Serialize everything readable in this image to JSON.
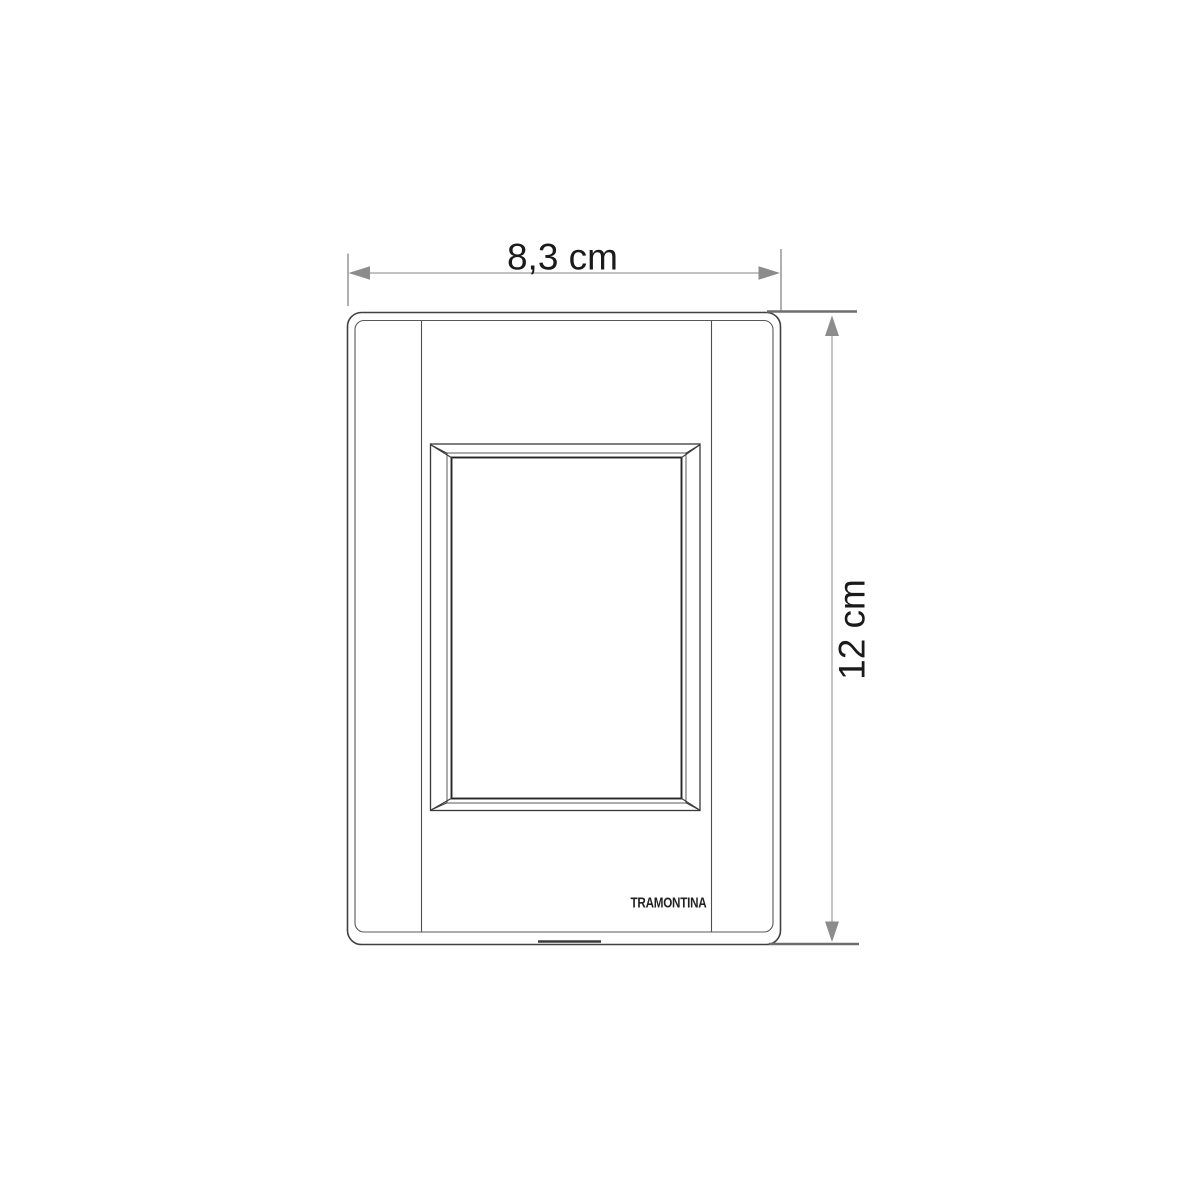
{
  "diagram": {
    "labels": {
      "width": "8,3 cm",
      "height": "12 cm",
      "brand": "TRAMONTINA"
    },
    "colors": {
      "background": "#ffffff",
      "drawing_line": "#414141",
      "inner_edge_line": "#585858",
      "opening_inner_line": "#262626",
      "dimension_line": "#adadad",
      "arrowhead": "#8c8c8c",
      "extension_line": "#8f8f8f",
      "extension_line_dark": "#6e6e6e",
      "label_text": "#1a1a1a",
      "brand_text": "#222222"
    }
  }
}
